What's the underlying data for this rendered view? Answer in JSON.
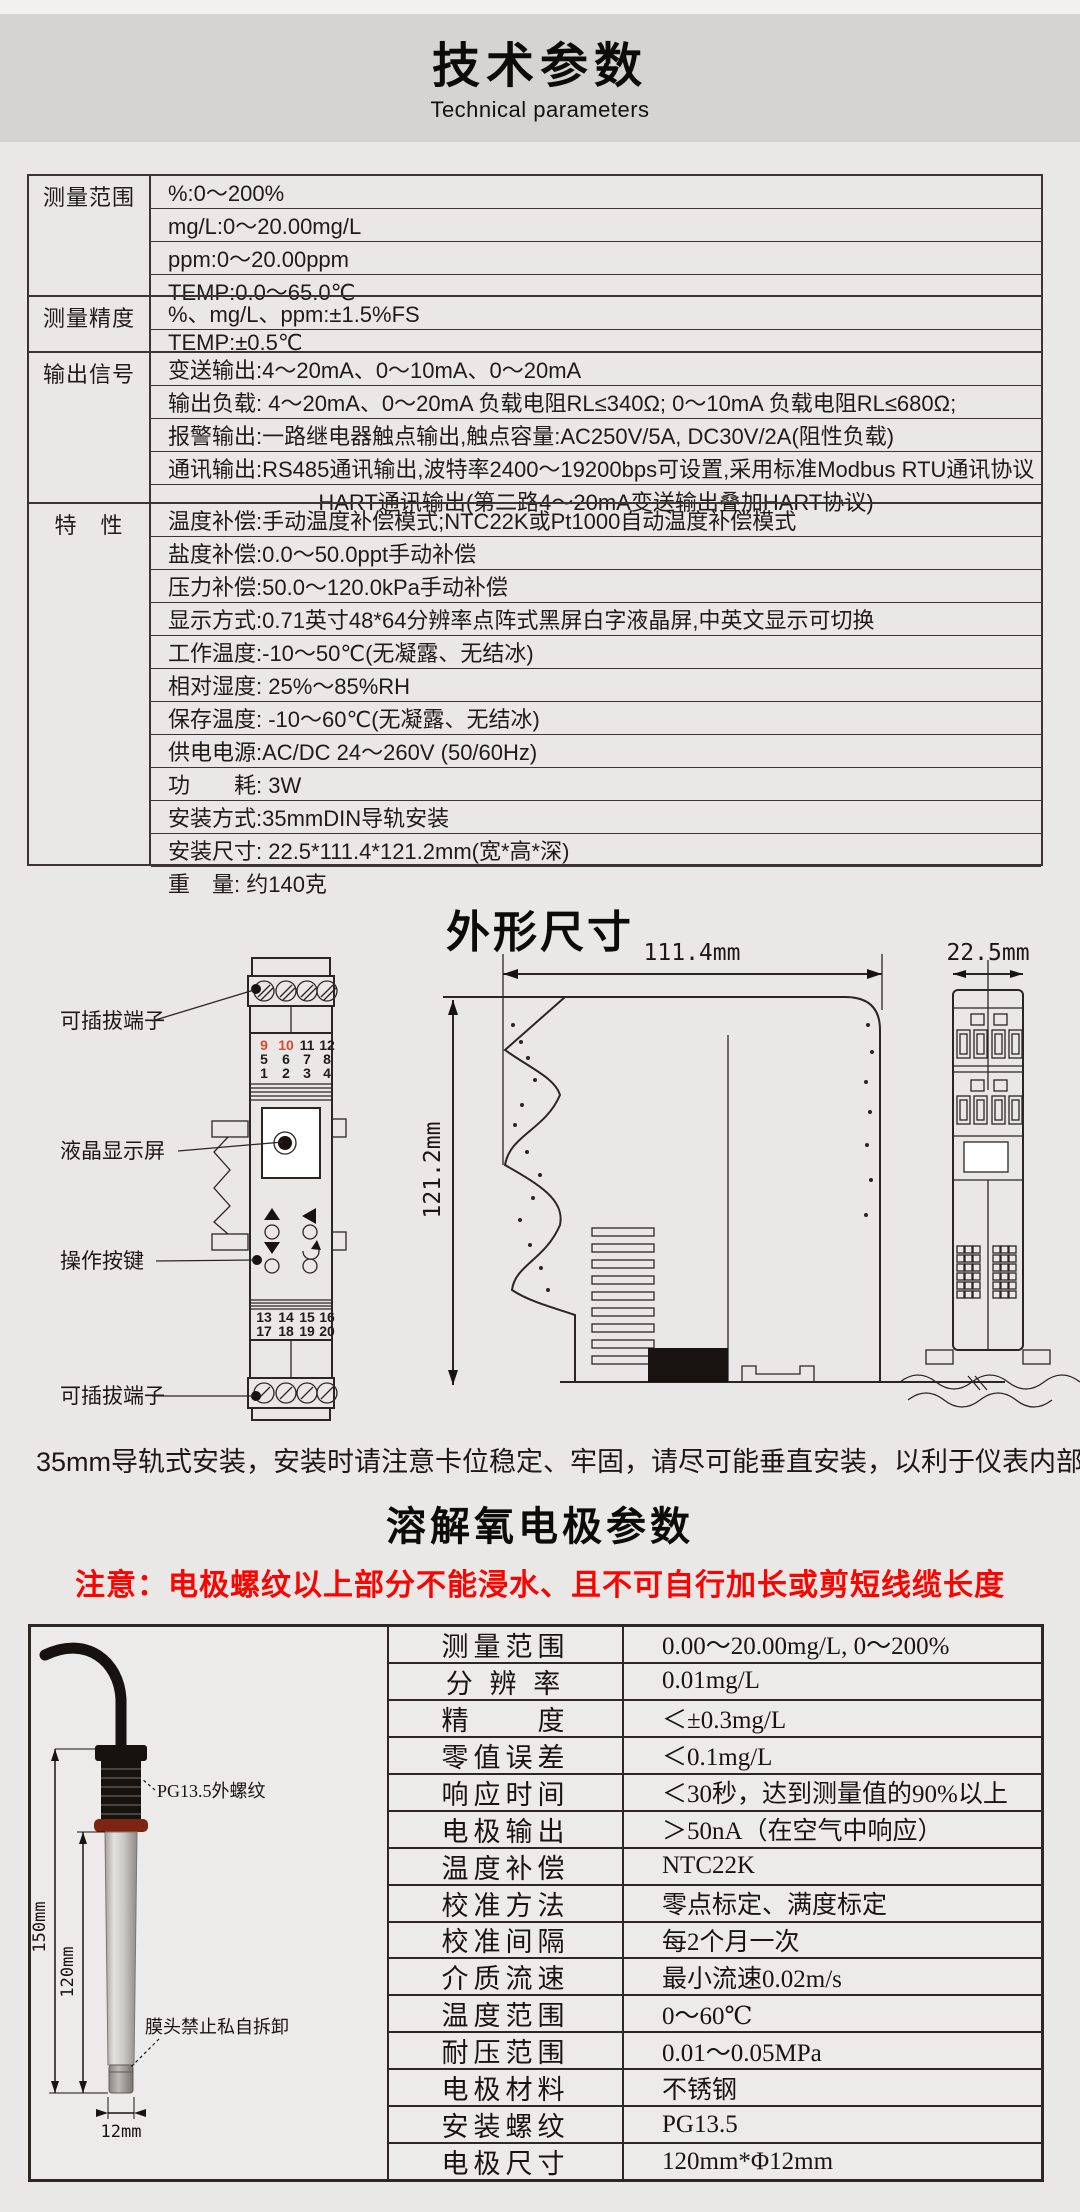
{
  "colors": {
    "page_bg": "#eae8e7",
    "band_bg": "#d6d4d3",
    "table_border": "#3c3431",
    "text": "#211b18",
    "warning_red": "#fb0400",
    "terminal_red": "#e8432b",
    "oring_red": "#7e2413"
  },
  "header": {
    "title": "技术参数",
    "subtitle": "Technical parameters"
  },
  "spec_table": {
    "groups": [
      {
        "label": "测量范围",
        "rows": [
          "%:0～200%",
          "mg/L:0～20.00mg/L",
          "ppm:0～20.00ppm",
          "TEMP:0.0～65.0℃"
        ]
      },
      {
        "label": "测量精度",
        "rows": [
          "%、mg/L、ppm:±1.5%FS",
          "TEMP:±0.5℃"
        ]
      },
      {
        "label": "输出信号",
        "rows": [
          "变送输出:4～20mA、0～10mA、0～20mA",
          "输出负载: 4～20mA、0～20mA 负载电阻RL≤340Ω; 0～10mA 负载电阻RL≤680Ω;",
          "报警输出:一路继电器触点输出,触点容量:AC250V/5A, DC30V/2A(阻性负载)",
          "通讯输出:RS485通讯输出,波特率2400～19200bps可设置,采用标准Modbus RTU通讯协议",
          "HART通讯输出(第二路4～20mA变送输出叠加HART协议)"
        ],
        "centered_rows": [
          4
        ]
      },
      {
        "label": "特　性",
        "rows": [
          "温度补偿:手动温度补偿模式;NTC22K或Pt1000自动温度补偿模式",
          "盐度补偿:0.0～50.0ppt手动补偿",
          "压力补偿:50.0～120.0kPa手动补偿",
          "显示方式:0.71英寸48*64分辨率点阵式黑屏白字液晶屏,中英文显示可切换",
          "工作温度:-10～50℃(无凝露、无结冰)",
          "相对湿度: 25%～85%RH",
          "保存温度: -10～60℃(无凝露、无结冰)",
          "供电电源:AC/DC 24～260V (50/60Hz)",
          "功　　耗: 3W",
          "安装方式:35mmDIN导轨安装",
          "安装尺寸: 22.5*111.4*121.2mm(宽*高*深)",
          "重　量: 约140克"
        ]
      }
    ]
  },
  "outline": {
    "title": "外形尺寸",
    "note": "35mm导轨式安装，安装时请注意卡位稳定、牢固，请尽可能垂直安装，以利于仪表内部热量散发。",
    "front_view": {
      "labels": {
        "terminal_top": "可插拔端子",
        "lcd": "液晶显示屏",
        "buttons": "操作按键",
        "terminal_bottom": "可插拔端子"
      },
      "terminal_rows_top": [
        [
          "9",
          "10",
          "11",
          "12"
        ],
        [
          "5",
          "6",
          "7",
          "8"
        ],
        [
          "1",
          "2",
          "3",
          "4"
        ]
      ],
      "red_terminals": [
        "9",
        "10"
      ],
      "terminal_rows_bottom": [
        [
          "13",
          "14",
          "15",
          "16"
        ],
        [
          "17",
          "18",
          "19",
          "20"
        ]
      ]
    },
    "dims": {
      "width": "111.4mm",
      "height": "121.2mm",
      "depth": "22.5mm"
    }
  },
  "electrode": {
    "title": "溶解氧电极参数",
    "warning": "注意：电极螺纹以上部分不能浸水、且不可自行加长或剪短线缆长度",
    "probe": {
      "thread_label": "PG13.5外螺纹",
      "head_label": "膜头禁止私自拆卸",
      "dim_length": "150mm",
      "dim_body": "120mm",
      "dim_diameter": "12mm"
    },
    "table": {
      "rows": [
        [
          "测量范围",
          "0.00～20.00mg/L, 0～200%"
        ],
        [
          "分 辨 率",
          "0.01mg/L"
        ],
        [
          "精　　度",
          "＜±0.3mg/L"
        ],
        [
          "零值误差",
          "＜0.1mg/L"
        ],
        [
          "响应时间",
          "＜30秒，达到测量值的90%以上"
        ],
        [
          "电极输出",
          "＞50nA（在空气中响应）"
        ],
        [
          "温度补偿",
          "NTC22K"
        ],
        [
          "校准方法",
          "零点标定、满度标定"
        ],
        [
          "校准间隔",
          "每2个月一次"
        ],
        [
          "介质流速",
          "最小流速0.02m/s"
        ],
        [
          "温度范围",
          "0～60℃"
        ],
        [
          "耐压范围",
          "0.01～0.05MPa"
        ],
        [
          "电极材料",
          "不锈钢"
        ],
        [
          "安装螺纹",
          "PG13.5"
        ],
        [
          "电极尺寸",
          "120mm*Φ12mm"
        ]
      ]
    }
  }
}
